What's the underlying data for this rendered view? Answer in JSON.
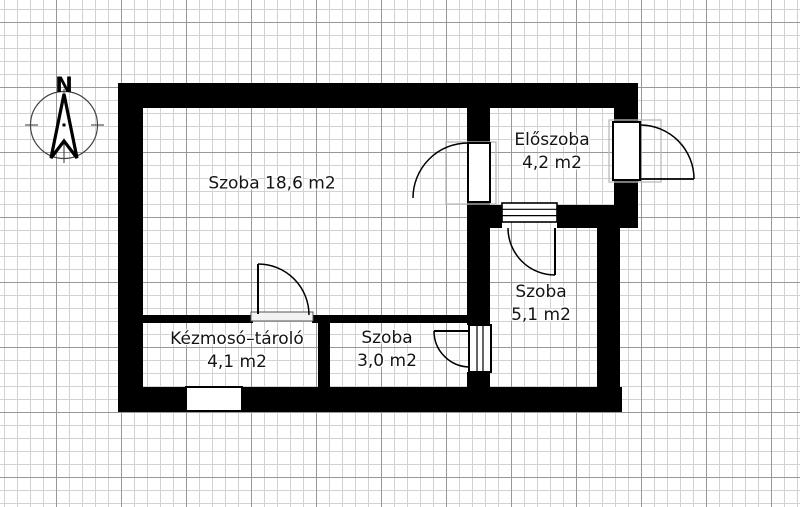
{
  "compass": {
    "north_label": "N"
  },
  "rooms": {
    "main": {
      "label": "Szoba 18,6 m2"
    },
    "eloszoba": {
      "name": "Előszoba",
      "area": "4,2 m2"
    },
    "szoba_right": {
      "name": "Szoba",
      "area": "5,1 m2"
    },
    "kezmoso": {
      "name": "Kézmosó–tároló",
      "area": "4,1 m2"
    },
    "szoba_bottom": {
      "name": "Szoba",
      "area": "3,0 m2"
    }
  },
  "colors": {
    "wall": "#000000",
    "paper": "#ffffff",
    "grid_minor": "#d2d2d2",
    "grid_major": "#989898",
    "text": "#141414"
  }
}
